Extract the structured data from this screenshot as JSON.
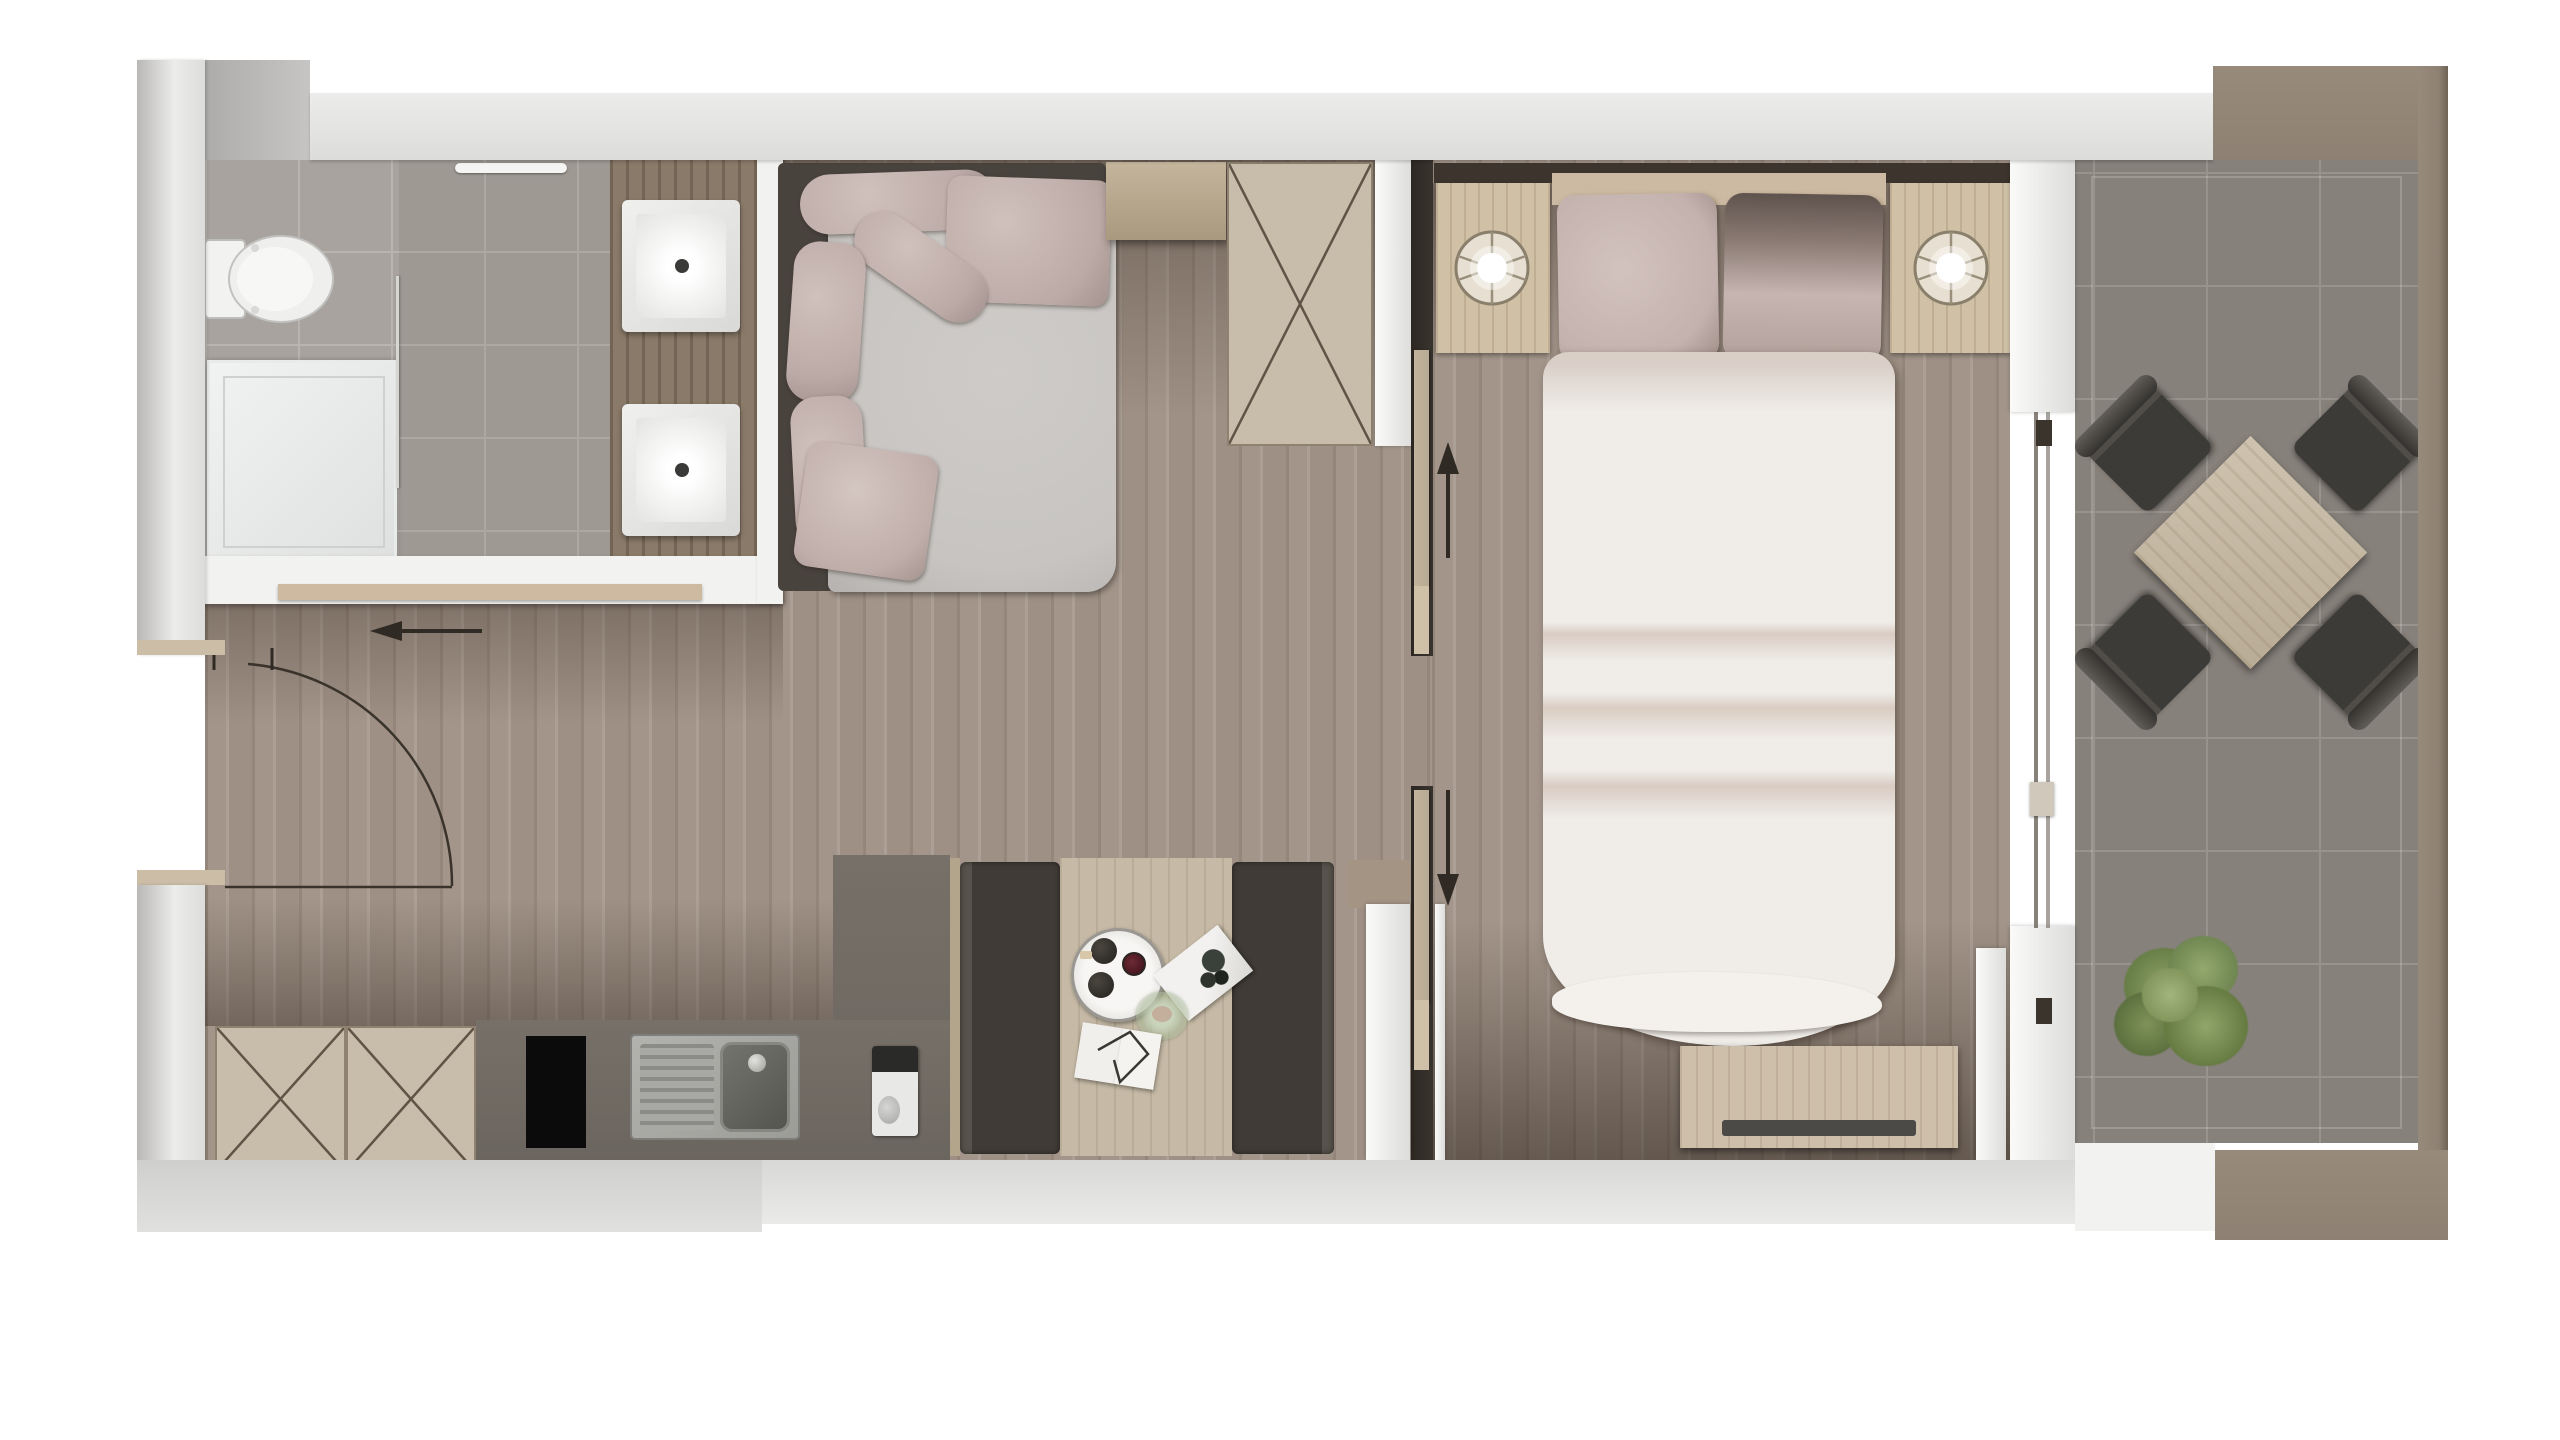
{
  "document": {
    "kind": "floor-plan-rendering",
    "view": "top-down",
    "style": "photorealistic 3D architectural render of a studio / one-bedroom apartment",
    "visible_text": "none",
    "background": "#ffffff"
  },
  "colors": {
    "wall": "#dcdcda",
    "wallLight": "#ececea",
    "wallShade": "#b9b8b6",
    "brownFrame": "#8e8173",
    "brownEdge": "#6d6256",
    "woodFloor": "#a3958a",
    "woodShadow": "#5f5146",
    "bathTile": "#a9a39f",
    "grout": "#bab4b0",
    "balconyTile": "#87817b",
    "groutB": "#99938d",
    "counterDark": "#6b655f",
    "cabinetBeige": "#c8bcab",
    "crossLine": "#5f5446",
    "sofaFrame": "#49433e",
    "seatGray": "#c7c4c1",
    "pillowMauve": "#bcaaa6",
    "bedWhite": "#f0ede9",
    "bedCrease": "#d9ccc3",
    "headboard": "#3d352d",
    "bedHeadband": "#cdbaa2",
    "benchDark": "#403b36",
    "tableWood": "#c6baa6",
    "nightstandWood": "#cfc0a6",
    "chairDark": "#3d3b38",
    "plantGreen": "#7e9258",
    "plantDark": "#5c7140",
    "steel": "#a8a9a4",
    "cooktopBlack": "#0b0b0b",
    "white": "#f2f2f0",
    "tan": "#b7aa94",
    "pocketDark": "#3a342e",
    "arrow": "#2f2a24",
    "shelfTan": "#cdbaa1"
  },
  "rooms": [
    {
      "id": "bathroom",
      "position": "top-left",
      "floor": "grey ceramic tile"
    },
    {
      "id": "entry-hall",
      "position": "left",
      "floor": "wood plank"
    },
    {
      "id": "living-kitchen",
      "position": "center-left",
      "floor": "wood plank"
    },
    {
      "id": "bedroom",
      "position": "center-right",
      "floor": "wood plank"
    },
    {
      "id": "balcony",
      "position": "right",
      "floor": "dark grey tile"
    }
  ],
  "fixtures": {
    "bathroom": [
      "wall-hung toilet",
      "square shower tray",
      "glass shower screen",
      "towel rail",
      "vanity counter with 2 square basins"
    ],
    "living-kitchen": [
      "L-shaped corner sofa with 6 satin cushions",
      "low side cabinet",
      "double wardrobe with X cross symbol",
      "kitchen base cabinets with X cross symbols",
      "dark worktop",
      "black cooktop",
      "stainless sink with drainboard",
      "small coffee machine",
      "island counter",
      "dining nook: 2 charcoal benches + wood table"
    ],
    "nook_table_items": [
      "round white serving tray with 3 dark cups",
      "tilted magazine",
      "small green glass bowl",
      "open white book with wire"
    ],
    "bedroom": [
      "dark headboard wall strip",
      "2 wooden nightstands with round lamps",
      "double bed with 2 mauve pillow pairs and white duvet",
      "wood TV sideboard with dark TV bar"
    ],
    "balcony": [
      "square wooden table rotated 45°",
      "4 dark lounge chairs rotated 45°",
      "green potted plant"
    ]
  },
  "annotations": {
    "entry_door": "quarter-circle swing arc with leaf line, hinge at hall wall",
    "entry_arrow": {
      "direction": "left"
    },
    "partition_doors": [
      {
        "location": "living/bedroom top",
        "type": "sliding pocket door",
        "arrow": "up"
      },
      {
        "location": "living/bedroom bottom",
        "type": "sliding pocket door",
        "arrow": "down"
      }
    ],
    "balcony_door": "sliding glass door with two panels and handles",
    "closet_symbol": "X diagonal cross on wardrobe and kitchen cabinets"
  },
  "counts": {
    "sinks": 2,
    "lamps": 2,
    "balcony_chairs": 4,
    "benches": 2,
    "x_cross_boxes": 3,
    "arrows": 3
  }
}
